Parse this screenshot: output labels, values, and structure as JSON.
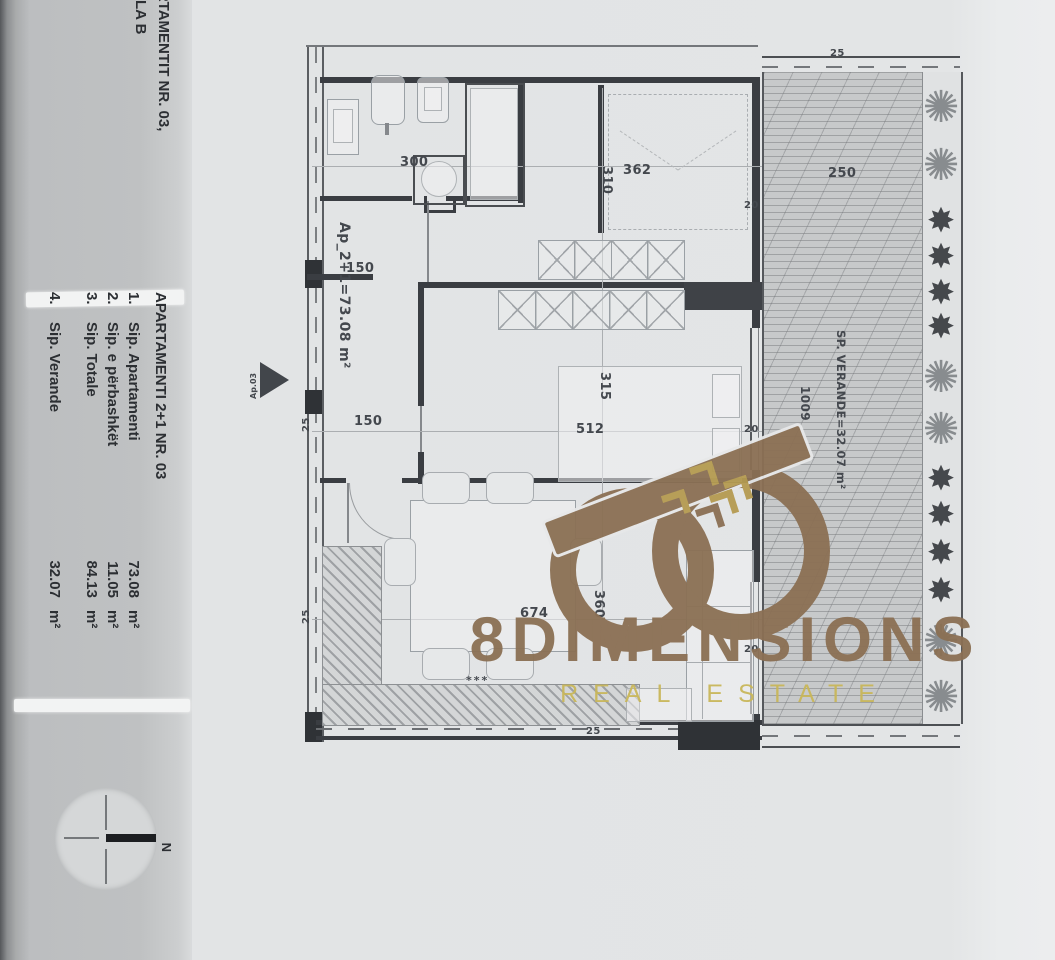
{
  "sidebar": {
    "title_line1": "ARTAMENTIT NR. 03,",
    "title_line2": "ALLA B",
    "table": {
      "header": "APARTAMENTI 2+1  NR. 03",
      "rows": [
        {
          "num": "1.",
          "label": "Sip. Apartamenti",
          "value": "73.08",
          "unit": "m²"
        },
        {
          "num": "2.",
          "label": "Sip. e përbashkët",
          "value": "11.05",
          "unit": "m²"
        },
        {
          "num": "3.",
          "label": "Sip. Totale",
          "value": "84.13",
          "unit": "m²"
        },
        {
          "num": "4.",
          "label": "Sip. Verande",
          "value": "32.07",
          "unit": "m²"
        }
      ]
    },
    "compass_label": "N"
  },
  "plan": {
    "apartment_area_label": "Ap_2+1=73.08 m²",
    "entrance_label": "Ap.03",
    "veranda_area_label": "SP. VERANDE=32.07 m²",
    "decor_marks": "***",
    "dims": {
      "bath_width": "300",
      "bed1_width": "362",
      "bed1_depth": "310",
      "hall_top": "150",
      "hall_mid": "150",
      "bed2_depth": "315",
      "bed2_width": "512",
      "living_width": "674",
      "living_depth": "360",
      "veranda_width": "250",
      "veranda_length": "1009",
      "wall_25_left_top": "25",
      "wall_25_left_bottom": "25",
      "wall_25_veranda_top": "25",
      "wall_25_bottom": "25",
      "wall_20_top": "20",
      "wall_20_mid": "20",
      "wall_20_bottom": "20"
    },
    "icons": {
      "star_plant": "✸",
      "bush_plant": "✺"
    },
    "plants": [
      "bush",
      "bush",
      "star",
      "star",
      "star",
      "star",
      "bush",
      "bush",
      "star",
      "star",
      "star",
      "star",
      "bush",
      "bush"
    ]
  },
  "watermark": {
    "brand": "8DIMENSIONS",
    "tagline": "REAL ESTATE",
    "brand_color": "#8b7054",
    "tagline_color": "#c9b75a"
  }
}
